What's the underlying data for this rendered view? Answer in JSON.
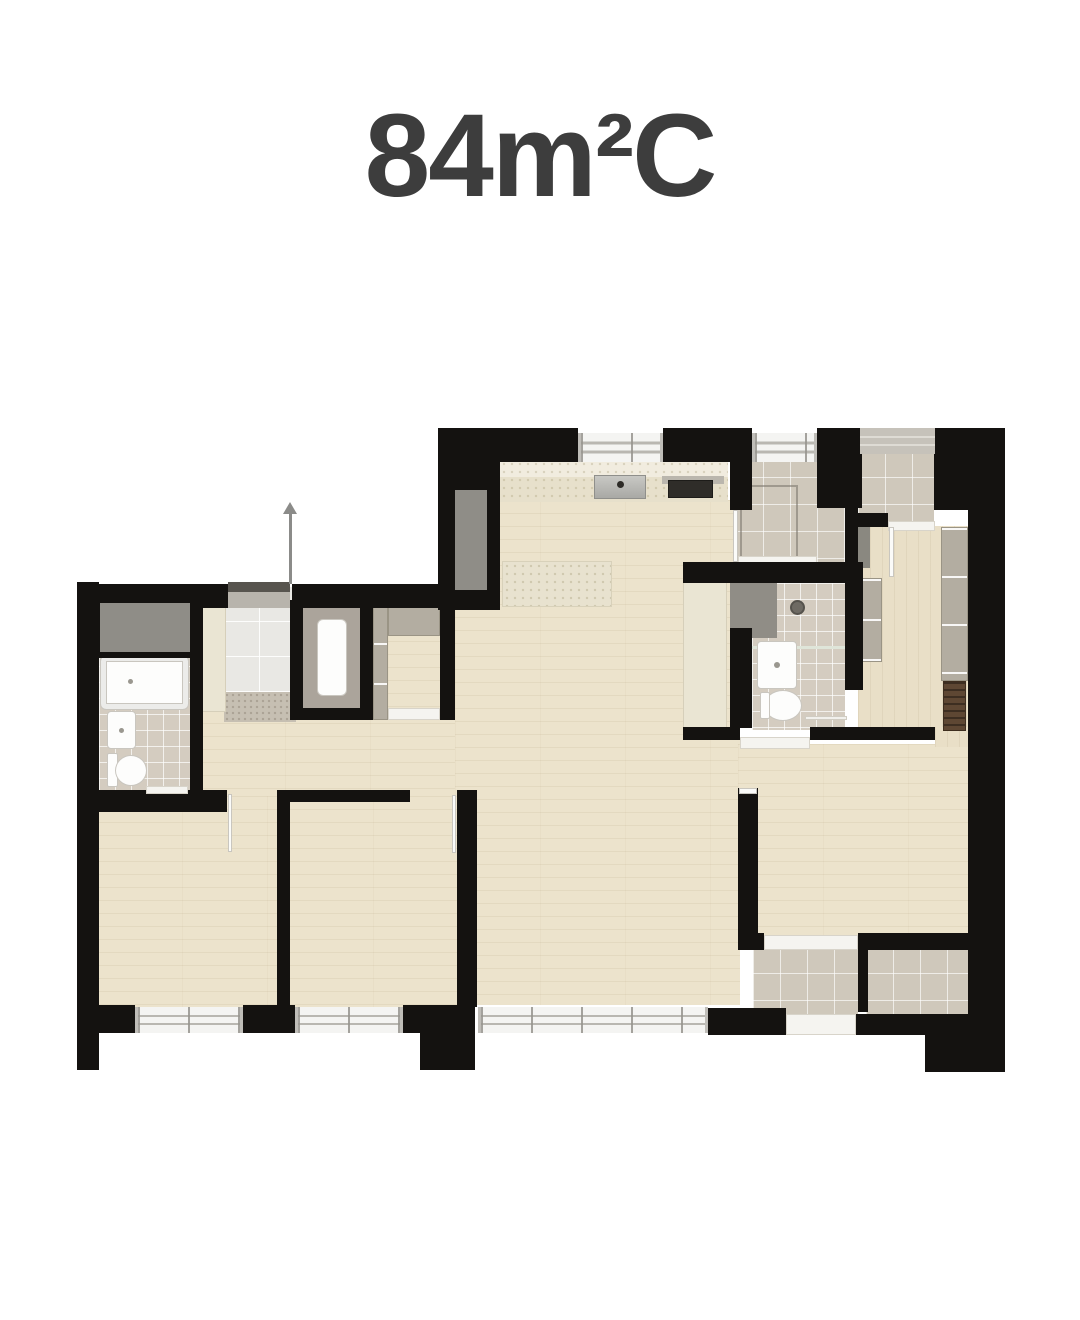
{
  "title": "84m²C",
  "colors": {
    "page_bg": "#ffffff",
    "title_text": "#3d3d3d",
    "wall": "#141210",
    "wood": "#ece3cc",
    "wood_dark": "#e9dfc7",
    "tile_bath": "#d4ccc0",
    "tile_balcony": "#cfc8bb",
    "tile_entry": "#e9e8e4",
    "mat": "#c6bfb2",
    "cream": "#eae5d3",
    "counter": "#e8e2cf",
    "window_gray": "#8f8d87",
    "wardrobe": "#b3ada1",
    "vanity": "#908d86",
    "fixture_white": "#fdfdfc",
    "stove_black": "#2f2d29",
    "cabinet_brown": "#5e4733",
    "sill_white": "#f5f4f0",
    "door_gray": "#b8b4ac",
    "door_dark": "#57544e",
    "arrow_gray": "#8b8b89"
  }
}
